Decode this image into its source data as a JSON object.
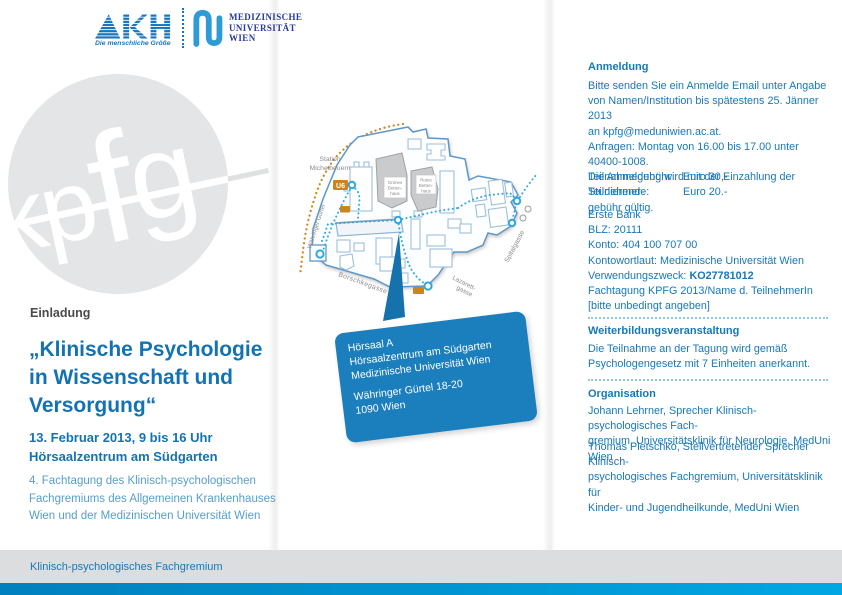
{
  "colors": {
    "accent_blue": "#1878B6",
    "title_blue": "#1373B2",
    "light_blue_text": "#569FC9",
    "dark_text": "#4A4A48",
    "callout_blue": "#1B7EBD",
    "route_blue": "#2FA8DF",
    "u6_orange": "#C9861F",
    "circle_gray": "#E3E5E7",
    "footer_bar_left": "#0080BE",
    "footer_bar_right": "#00A7E3"
  },
  "header": {
    "akh": {
      "name": "AKH",
      "tagline": "Die menschliche Größe"
    },
    "muw": {
      "line1": "MEDIZINISCHE",
      "line2": "UNIVERSITÄT",
      "line3": "WIEN"
    }
  },
  "watermark": {
    "letters": "kpfg"
  },
  "invitation": {
    "kicker": "Einladung",
    "title": "„Klinische Psychologie\nin Wissenschaft und\nVersorgung“",
    "datetime": "13. Februar 2013, 9 bis 16 Uhr\nHörsaalzentrum am Südgarten",
    "subtitle": "4. Fachtagung des Klinisch-psychologischen\nFachgremiums des Allgemeinen Krankenhauses\nWien und der Medizinischen Universität Wien"
  },
  "map": {
    "station": {
      "line1": "Station",
      "line2": "Michelbeuern"
    },
    "u6_badge": "U6",
    "streets": {
      "waehringer": "Währinger Gürtel",
      "borschke": "Borschkegasse",
      "lazarett1": "Lazarett-",
      "lazarett2": "gasse",
      "spital": "Spitalgasse"
    },
    "buildings": {
      "gruenes": [
        "Grünes",
        "Betten-",
        "haus"
      ],
      "rotes": [
        "Rotes",
        "Betten-",
        "haus"
      ]
    }
  },
  "callout": {
    "venue": "Hörsaal A\nHörsaalzentrum am Südgarten\nMedizinische Universität Wien",
    "address": "Währinger Gürtel 18-20\n1090 Wien"
  },
  "anmeldung": {
    "heading": "Anmeldung",
    "intro": "Bitte senden Sie ein Anmelde Email unter Angabe\nvon Namen/Institution bis spätestens 25. Jänner 2013\nan kpfg@meduniwien.ac.at.\nAnfragen: Montag von 16.00 bis 17.00 unter 40400-1008.\nDie Anmeldung wird mit der Einzahlung der Teilnehmer-\ngebühr gültig.",
    "fees": [
      {
        "label": "Teilnahmegebühr",
        "value": "Euro 30,-"
      },
      {
        "label": "Studierende:",
        "value": "Euro 20.-"
      }
    ],
    "bank_lines": "Erste Bank\nBLZ: 20111\nKonto: 404 100 707 00\nKontowortlaut: Medizinische Universität Wien",
    "zweck_label": "Verwendungszweck: ",
    "zweck_value": "KO27781012",
    "zweck_rest": "Fachtagung KPFG 2013/Name d. TeilnehmerIn\n[bitte unbedingt angeben]"
  },
  "weiterbildung": {
    "heading": "Weiterbildungsveranstaltung",
    "text": "Die Teilnahme an der Tagung wird gemäß\nPsychologengesetz mit 7 Einheiten anerkannt."
  },
  "organisation": {
    "heading": "Organisation",
    "person1": "Johann Lehrner, Sprecher Klinisch-psychologisches Fach-\ngremium, Universitätsklinik für Neurologie, MedUni Wien",
    "person2": "Thomas Pletschko, Stellvertretender Sprecher Klinisch-\npsychologisches Fachgremium, Universitätsklinik für\nKinder- und Jugendheilkunde, MedUni Wien"
  },
  "footer": {
    "text": "Klinisch-psychologisches Fachgremium"
  }
}
